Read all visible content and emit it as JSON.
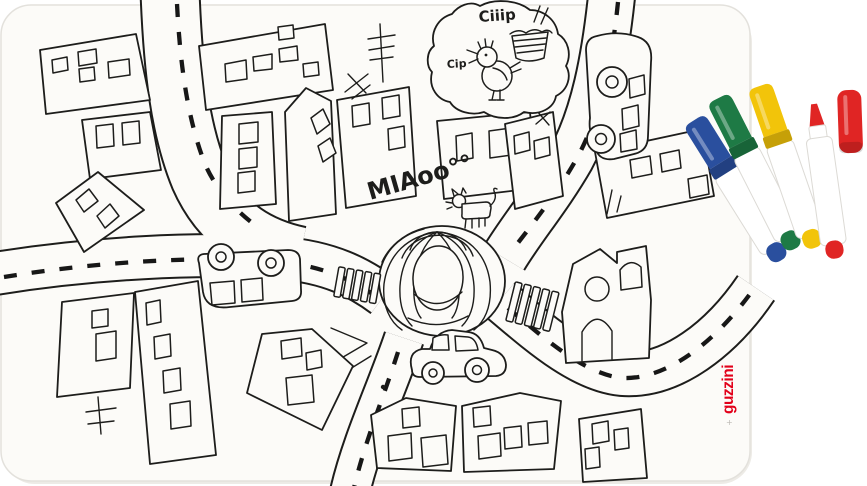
{
  "placemat": {
    "doodles": {
      "bird_call_loud": "Ciiip",
      "bird_call_soft": "Cip",
      "cat_call": "MIAoo°°"
    },
    "brand": {
      "label": "guzzini",
      "plus": "+",
      "color": "#e2001a"
    },
    "surface_color": "#fcfbf8",
    "ink_color": "#1d1d1b"
  },
  "markers": [
    {
      "name": "blue marker",
      "color": "#2a4f9e"
    },
    {
      "name": "green marker",
      "color": "#1e7a45"
    },
    {
      "name": "yellow marker",
      "color": "#f2c40a"
    },
    {
      "name": "red marker",
      "color": "#e02524"
    },
    {
      "name": "red marker cap",
      "color": "#e02524"
    }
  ]
}
